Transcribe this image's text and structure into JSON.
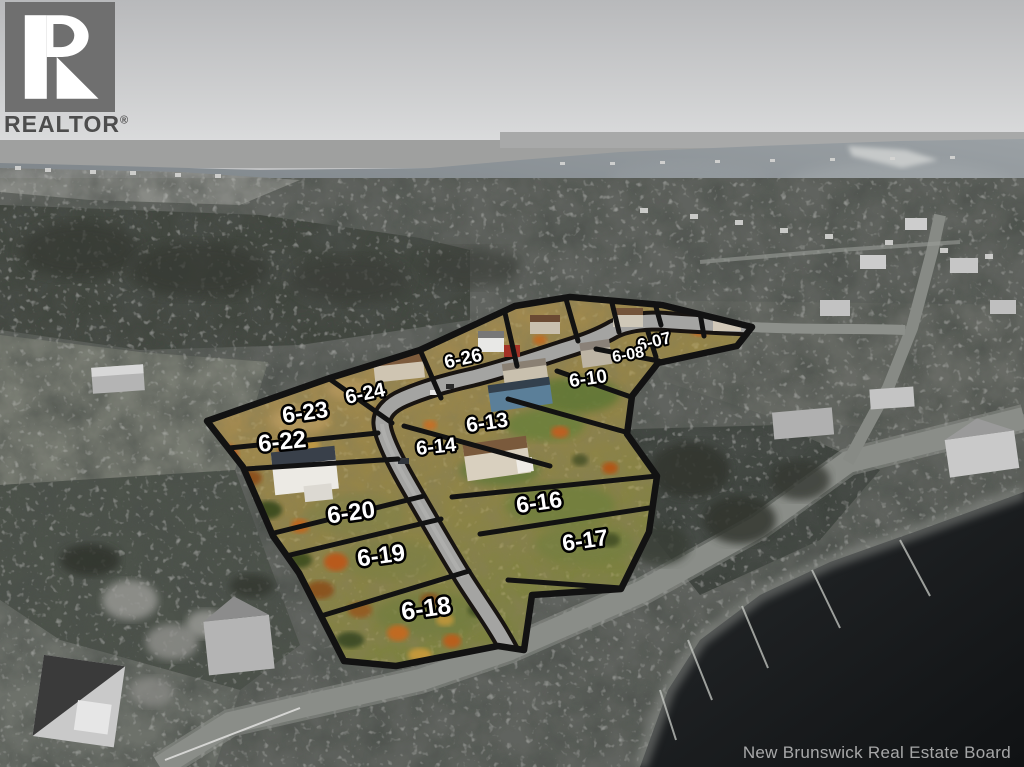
{
  "branding": {
    "logo_text": "REALTOR",
    "registered": "®"
  },
  "watermark": {
    "text": "New Brunswick Real Estate Board"
  },
  "lots": [
    {
      "label": "6-07"
    },
    {
      "label": "6-08"
    },
    {
      "label": "6-10"
    },
    {
      "label": "6-13"
    },
    {
      "label": "6-14"
    },
    {
      "label": "6-16"
    },
    {
      "label": "6-17"
    },
    {
      "label": "6-18"
    },
    {
      "label": "6-19"
    },
    {
      "label": "6-20"
    },
    {
      "label": "6-22"
    },
    {
      "label": "6-23"
    },
    {
      "label": "6-24"
    },
    {
      "label": "6-26"
    }
  ],
  "colors": {
    "label_fill": "#ffffff",
    "label_stroke": "#000000",
    "lot_line": "#121212",
    "logo_block": "#6f6f6f",
    "logo_mark": "#ffffff",
    "logo_text": "#4d4d4d",
    "watermark_text": "#b9b9b9",
    "highlight_tan": "#b08a58",
    "highlight_olive": "#8d8549",
    "highlight_green": "#6d7c3e",
    "water_gray": "#868d92",
    "dark_water": "#17191b"
  }
}
